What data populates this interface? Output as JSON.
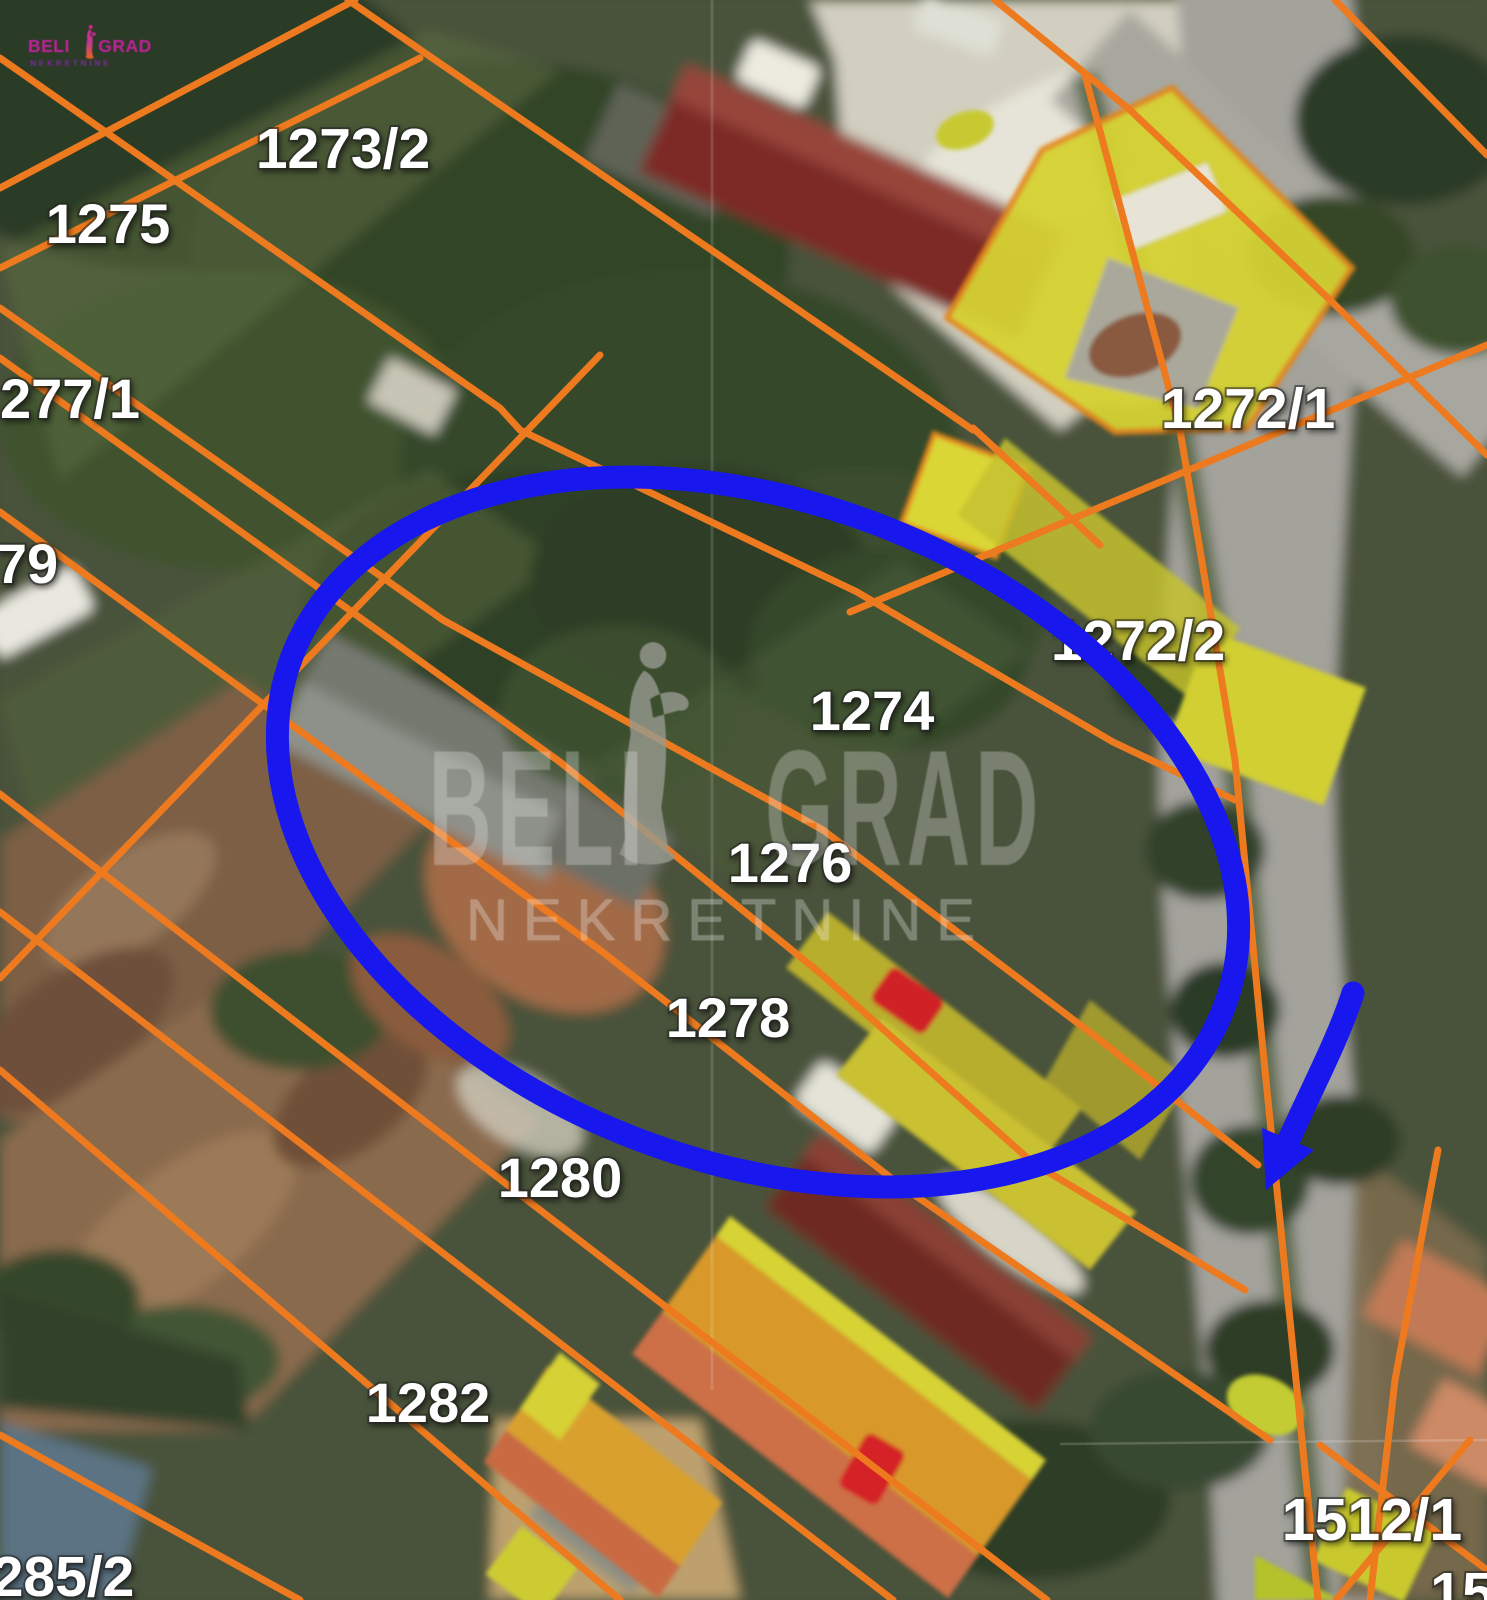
{
  "canvas": {
    "width": 1487,
    "height": 1600
  },
  "logo": {
    "title": "BELI GRAD",
    "subtitle": "NEKRETNINE",
    "title_color": "#c2219c",
    "subtitle_color": "#7c2b9b",
    "statue_color": "#e8641e"
  },
  "watermark": {
    "word_left": "BELI",
    "word_right": "GRAD",
    "subtitle": "NEKRETNINE",
    "statue_icon": "statue-icon",
    "text_color": "rgba(235,235,235,0.32)"
  },
  "annotation": {
    "tool": "freehand-highlight",
    "color": "#1717ee",
    "shapes": [
      "hand-drawn ellipse around parcels 1274/1276",
      "arrow pointing to street access"
    ]
  },
  "map": {
    "type": "cadastral-satellite",
    "boundary_color": "#ed7a1f",
    "highlight_color": "#d6d335",
    "label_color": "#ffffff",
    "parcel_labels": [
      {
        "text": "1273/2",
        "x": 343,
        "y": 168,
        "size": 57
      },
      {
        "text": "1275",
        "x": 108,
        "y": 243,
        "size": 56
      },
      {
        "text": "277/1",
        "x": 70,
        "y": 418,
        "size": 56
      },
      {
        "text": "79",
        "x": 27,
        "y": 583,
        "size": 56
      },
      {
        "text": "1272/1",
        "x": 1248,
        "y": 428,
        "size": 57
      },
      {
        "text": "1272/2",
        "x": 1138,
        "y": 660,
        "size": 57
      },
      {
        "text": "1274",
        "x": 872,
        "y": 730,
        "size": 56
      },
      {
        "text": "1276",
        "x": 790,
        "y": 882,
        "size": 56
      },
      {
        "text": "1278",
        "x": 728,
        "y": 1037,
        "size": 56
      },
      {
        "text": "1280",
        "x": 560,
        "y": 1197,
        "size": 56
      },
      {
        "text": "1282",
        "x": 428,
        "y": 1422,
        "size": 56
      },
      {
        "text": "285/2",
        "x": 63,
        "y": 1596,
        "size": 57
      },
      {
        "text": "1512/1",
        "x": 1372,
        "y": 1540,
        "size": 59
      },
      {
        "text": "15",
        "x": 1462,
        "y": 1612,
        "size": 57
      }
    ]
  }
}
